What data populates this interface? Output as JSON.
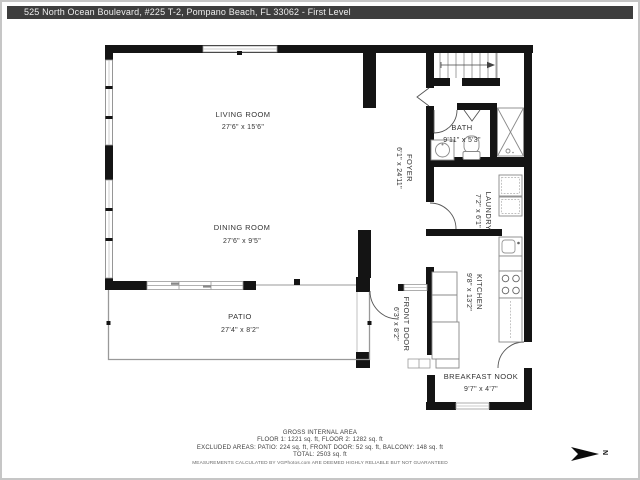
{
  "header": {
    "title": "525 North Ocean Boulevard, #225  T-2, Pompano Beach, FL 33062 - First Level"
  },
  "rooms": {
    "living": {
      "name": "LIVING ROOM",
      "dims": "27'6\" x 15'6\""
    },
    "dining": {
      "name": "DINING ROOM",
      "dims": "27'6\" x 9'5\""
    },
    "patio": {
      "name": "PATIO",
      "dims": "27'4\" x 8'2\""
    },
    "foyer": {
      "name": "FOYER",
      "dims": "6'1\" x 24'11\""
    },
    "bath": {
      "name": "BATH",
      "dims": "9'11\" x 5'3\""
    },
    "laundry": {
      "name": "LAUNDRY",
      "dims": "7'2\" x 6'1\""
    },
    "kitchen": {
      "name": "KITCHEN",
      "dims": "9'8\" x 13'2\""
    },
    "breakfast_nook": {
      "name": "BREAKFAST NOOK",
      "dims": "9'7\" x 4'7\""
    },
    "front_door": {
      "name": "FRONT DOOR",
      "dims": "6'3\" x 8'2\""
    }
  },
  "footer": {
    "title": "GROSS INTERNAL AREA",
    "floors": "FLOOR 1: 1221 sq. ft, FLOOR 2: 1282 sq. ft",
    "excluded": "EXCLUDED AREAS: PATIO: 224 sq. ft, FRONT DOOR: 52 sq. ft, BALCONY: 148 sq. ft",
    "total": "TOTAL: 2503 sq. ft",
    "disclaimer": "MEASUREMENTS CALCULATED BY VGPhotos.com ARE DEEMED HIGHLY RELIABLE BUT NOT GUARANTEED"
  },
  "compass": {
    "label": "N"
  },
  "colors": {
    "wall": "#141414",
    "header_bg": "#3e3e3e",
    "thin_line": "#999999",
    "text": "#3c3c3c"
  }
}
